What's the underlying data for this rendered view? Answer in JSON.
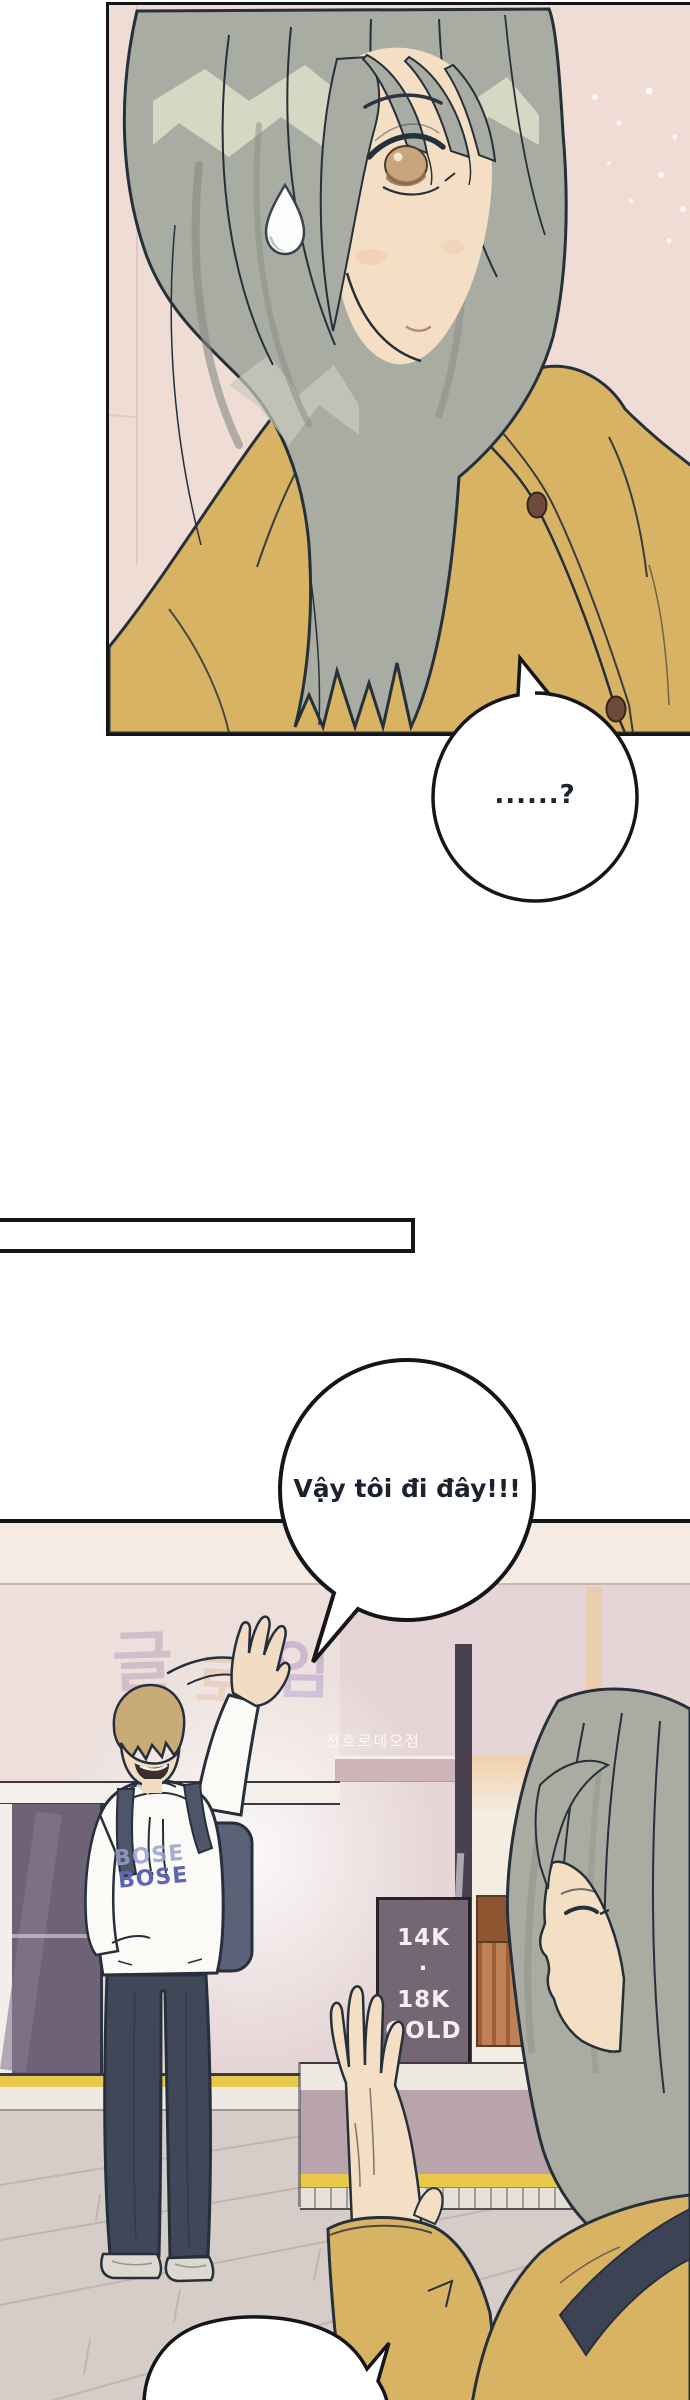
{
  "comic": {
    "bubbles": {
      "question": "......?",
      "farewell": "Vậy tôi đi đây!!!"
    },
    "signs": {
      "branch": "천호로데오점",
      "gold": [
        "14K",
        "·",
        "18K",
        "GOLD"
      ],
      "wall_letters": [
        "글",
        "로",
        "임"
      ],
      "hoodie_print": "BOSE"
    },
    "colors": {
      "ink": "#26303b",
      "cardigan_yellow": "#d9b364",
      "girl_hair_gray": "#aaaca1",
      "boy_hair_tan": "#c9ab77",
      "panel1_wall_pink": "#eedcd5",
      "panel2_wall_mauve": "#e6d5d6",
      "gold_sign_bg": "#756673",
      "pants_navy": "#3f4759",
      "curb_stripe_yellow": "#e8c94c",
      "hoodie_print_blue": "#5d65b0"
    }
  }
}
